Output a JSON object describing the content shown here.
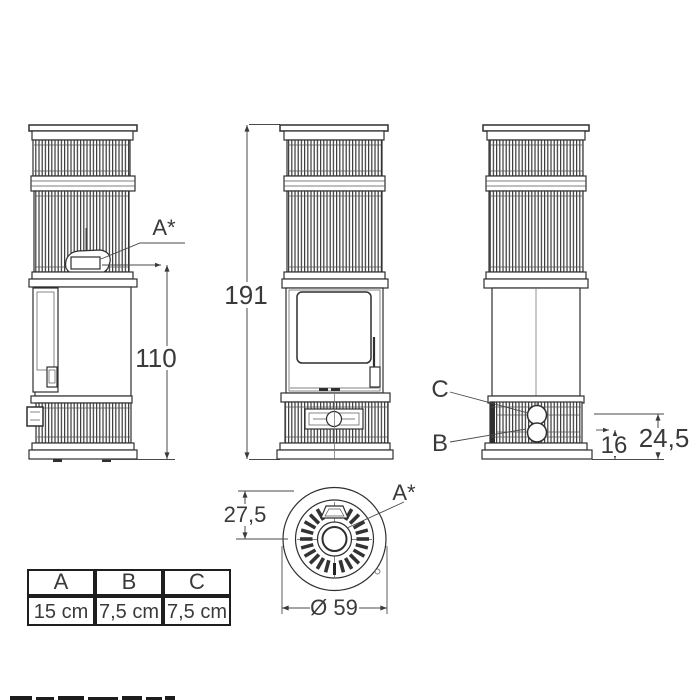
{
  "colors": {
    "background": "#ffffff",
    "line": "#2f2f2f",
    "text": "#3a3a3a"
  },
  "labels": {
    "a_star": "A*",
    "b": "B",
    "c": "C"
  },
  "dims": {
    "total_height": "191",
    "side_outlet_height": "110",
    "rear_c_height": "24,5",
    "rear_b_height": "16",
    "top_offset": "27,5",
    "diameter": "Ø 59"
  },
  "table": {
    "headers": [
      "A",
      "B",
      "C"
    ],
    "values": [
      "15 cm",
      "7,5 cm",
      "7,5 cm"
    ]
  }
}
